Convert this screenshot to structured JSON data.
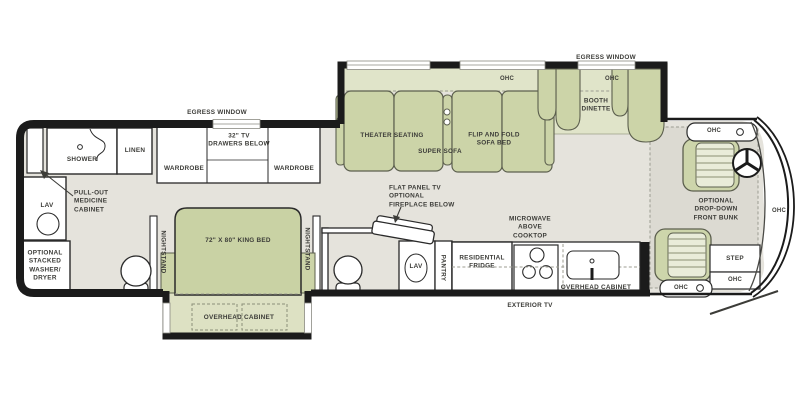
{
  "colors": {
    "floor": "#e5e3dc",
    "furniture_green": "#ccd4a8",
    "furniture_green_light": "#e0e4c9",
    "wall": "#1b1b1b",
    "fixture_white": "#ffffff",
    "text": "#3c3c38"
  },
  "common": {
    "ohc": "OHC",
    "egress_window": "EGRESS WINDOW",
    "wardrobe": "WARDROBE",
    "lav": "LAV",
    "nightstand": "NIGHTSTAND",
    "overhead_cabinet": "OVERHEAD CABINET"
  },
  "rear_bath": {
    "shower": "SHOWER",
    "linen": "LINEN",
    "medicine_cabinet": "PULL-OUT\nMEDICINE\nCABINET",
    "washer_dryer": "OPTIONAL\nSTACKED\nWASHER/\nDRYER"
  },
  "bedroom": {
    "tv": "32\" TV\nDRAWERS BELOW",
    "king_bed": "72\" X 80\" KING BED"
  },
  "living": {
    "theater": "THEATER SEATING",
    "super_sofa": "SUPER SOFA",
    "flip_fold": "FLIP AND FOLD\nSOFA BED",
    "booth": "BOOTH\nDINETTE"
  },
  "mid_bath": {
    "flat_tv": "FLAT PANEL TV\nOPTIONAL\nFIREPLACE BELOW",
    "pantry": "PANTRY"
  },
  "kitchen": {
    "microwave": "MICROWAVE\nABOVE\nCOOKTOP",
    "fridge": "RESIDENTIAL\nFRIDGE",
    "exterior_tv": "EXTERIOR TV"
  },
  "cab": {
    "bunk": "OPTIONAL\nDROP-DOWN\nFRONT BUNK",
    "step": "STEP"
  }
}
